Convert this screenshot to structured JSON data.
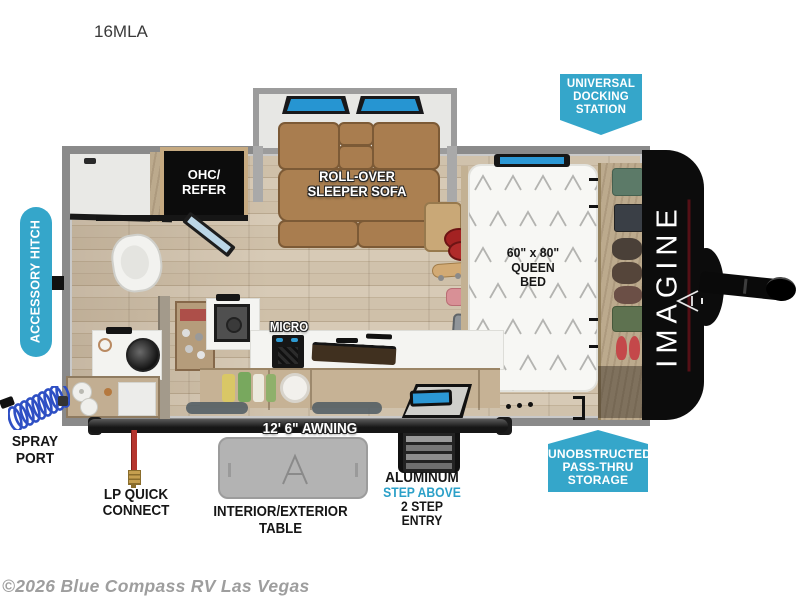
{
  "title": {
    "model": "16MLA"
  },
  "watermark": {
    "text": "©2026 Blue Compass RV Las Vegas"
  },
  "badges": {
    "docking": {
      "line1": "UNIVERSAL",
      "line2": "DOCKING",
      "line3": "STATION"
    },
    "accessory_hitch": {
      "label": "ACCESSORY HITCH"
    },
    "passthru": {
      "line1": "UNOBSTRUCTED",
      "line2": "PASS-THRU",
      "line3": "STORAGE"
    }
  },
  "floorplan": {
    "brand": "IMAGINE",
    "ohc": {
      "line1": "OHC/",
      "line2": "REFER"
    },
    "sofa": {
      "line1": "ROLL-OVER",
      "line2": "SLEEPER SOFA"
    },
    "bed": {
      "line1": "60\" x 80\"",
      "line2": "QUEEN",
      "line3": "BED"
    },
    "micro": "MICRO",
    "awning": "12' 6\" AWNING"
  },
  "callouts": {
    "spray": {
      "line1": "SPRAY",
      "line2": "PORT"
    },
    "lp": {
      "line1": "LP QUICK",
      "line2": "CONNECT"
    },
    "table": "INTERIOR/EXTERIOR TABLE",
    "entry": {
      "line1": "ALUMINUM",
      "line2": "STEP ABOVE",
      "line3": "2 STEP ENTRY"
    }
  },
  "colors": {
    "badge_cyan": "#35A6CA",
    "accent_cyan": "#2BA0C8",
    "sofa_brown": "#A87C4E",
    "cap_black": "#0C0C0C",
    "floor_wood": "#C9BBA6",
    "awning_black": "#1C1C1C",
    "underline_red": "#551016"
  }
}
